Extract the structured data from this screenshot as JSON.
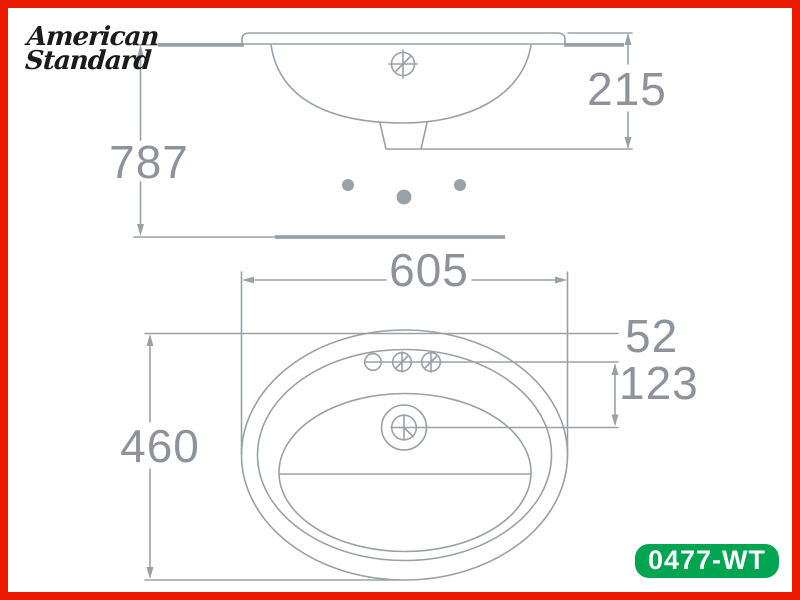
{
  "brand": {
    "name_line1": "American",
    "name_line2": "Standard"
  },
  "badge": {
    "model": "0477-WT"
  },
  "dimensions": {
    "floor_to_rim_height": "787",
    "rim_to_outlet_height": "215",
    "overall_width": "605",
    "rim_to_faucet_holes": "52",
    "faucet_holes_to_drain": "123",
    "overall_depth": "460"
  },
  "views": {
    "side_view": {
      "name": "front/side elevation of basin",
      "dimension_labels": [
        "787",
        "215"
      ],
      "features": [
        "countertop-line",
        "basin-profile",
        "overflow-symbol",
        "drain-outlet",
        "three-mounting-dots",
        "floor-line"
      ]
    },
    "plan_view": {
      "name": "top plan of basin",
      "dimension_labels": [
        "605",
        "52",
        "123",
        "460"
      ],
      "features": [
        "outer-rim-oval",
        "inner-rim-oval",
        "basin-oval",
        "overflow-shelf-line",
        "three-faucet-holes",
        "drain-circles"
      ]
    }
  },
  "colors": {
    "border_red": "#ea1b02",
    "badge_green": "#00a551",
    "badge_text": "#ffffff",
    "line_gray": "#9aa0a7",
    "dimension_text_gray": "#8d929b",
    "logo_black": "#1b1b1b",
    "background": "#ffffff"
  }
}
